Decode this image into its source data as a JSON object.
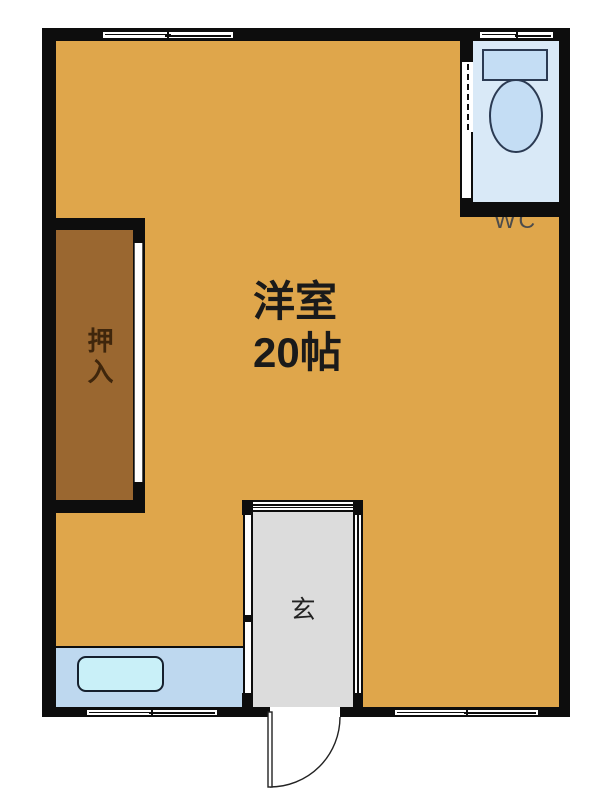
{
  "colors": {
    "wall": "#0d0d0d",
    "room-orange": "#dfa64b",
    "closet-brown": "#9a6730",
    "closet-text": "#3f260c",
    "wc-bg": "#d9e9f7",
    "toilet-fill": "#c4ddf4",
    "toilet-stroke": "#2b3a52",
    "entrance-gray": "#dcdcdc",
    "bath-bg": "#bed8ef",
    "bathtub-fill": "#c9f0f8",
    "label-dark": "#1a1a1a",
    "wc-text": "#4c4c4c"
  },
  "rooms": {
    "main": {
      "name_line1": "洋室",
      "name_line2": "20帖"
    },
    "closet": {
      "name": "押入"
    },
    "wc": {
      "name": "WC"
    },
    "entrance": {
      "name": "玄"
    }
  }
}
